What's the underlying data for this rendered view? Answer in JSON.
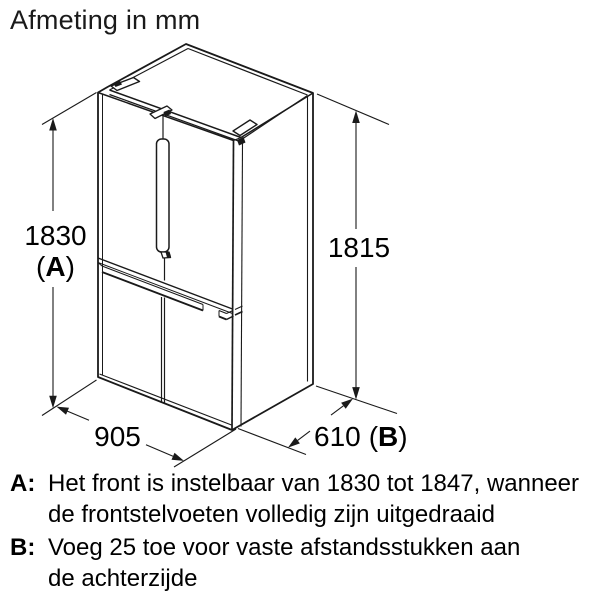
{
  "title": "Afmeting in mm",
  "drawing": {
    "dimensions": {
      "height_front": {
        "value": "1830",
        "ref": "A"
      },
      "height_side": {
        "value": "1815"
      },
      "width": {
        "value": "905"
      },
      "depth": {
        "value": "610",
        "ref": "B"
      }
    },
    "punct": {
      "open": "(",
      "close": ")"
    }
  },
  "footnotes": [
    {
      "marker": "A:",
      "lines": [
        "Het front is instelbaar van 1830 tot 1847, wanneer",
        "de frontstelvoeten volledig zijn uitgedraaid"
      ]
    },
    {
      "marker": "B:",
      "lines": [
        "Voeg 25 toe voor vaste afstandsstukken aan",
        "de achterzijde"
      ]
    }
  ],
  "colors": {
    "line": "#1a1a1a",
    "text": "#000000",
    "background": "#ffffff"
  }
}
